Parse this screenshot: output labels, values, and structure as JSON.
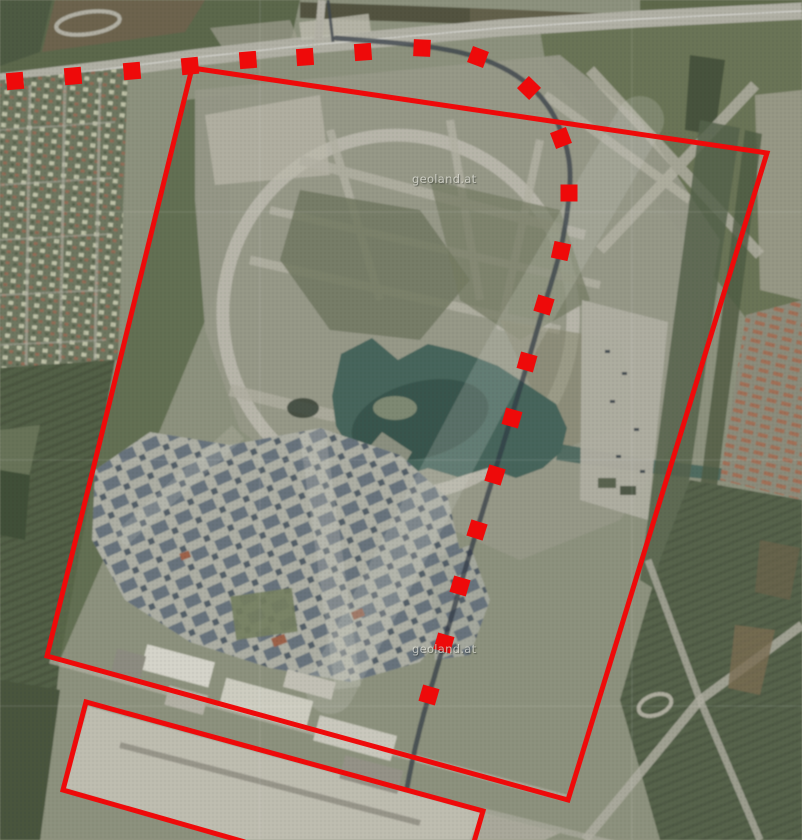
{
  "map": {
    "type": "aerial-orthophoto",
    "description": "Aerial photo with red planning boundary overlays and square-dot route line",
    "watermarks": [
      {
        "text": "geoland.at",
        "x": 412,
        "y": 172
      },
      {
        "text": "geoland.at",
        "x": 412,
        "y": 642
      }
    ],
    "annotations": {
      "color": "#ee0a0a",
      "boundary_polygon": {
        "style": "solid",
        "stroke_width": 5,
        "closed": true,
        "points": [
          [
            192,
            68
          ],
          [
            767,
            153
          ],
          [
            568,
            800
          ],
          [
            47,
            656
          ]
        ]
      },
      "south_area_outline": {
        "style": "solid",
        "stroke_width": 5,
        "closed": false,
        "points": [
          [
            245,
            842
          ],
          [
            63,
            790
          ],
          [
            86,
            702
          ],
          [
            483,
            811
          ],
          [
            474,
            842
          ]
        ]
      },
      "dashed_route": {
        "style": "square-dots",
        "dot_size": 17,
        "points": [
          [
            15,
            81
          ],
          [
            73,
            76
          ],
          [
            132,
            71
          ],
          [
            190,
            66
          ],
          [
            248,
            60
          ],
          [
            305,
            57
          ],
          [
            363,
            52
          ],
          [
            422,
            48
          ],
          [
            478,
            57
          ],
          [
            529,
            88
          ],
          [
            561,
            138
          ],
          [
            569,
            193
          ],
          [
            561,
            251
          ],
          [
            544,
            305
          ],
          [
            527,
            362
          ],
          [
            512,
            418
          ],
          [
            495,
            475
          ],
          [
            477,
            530
          ],
          [
            460,
            586
          ],
          [
            444,
            643
          ],
          [
            429,
            695
          ]
        ]
      }
    }
  }
}
